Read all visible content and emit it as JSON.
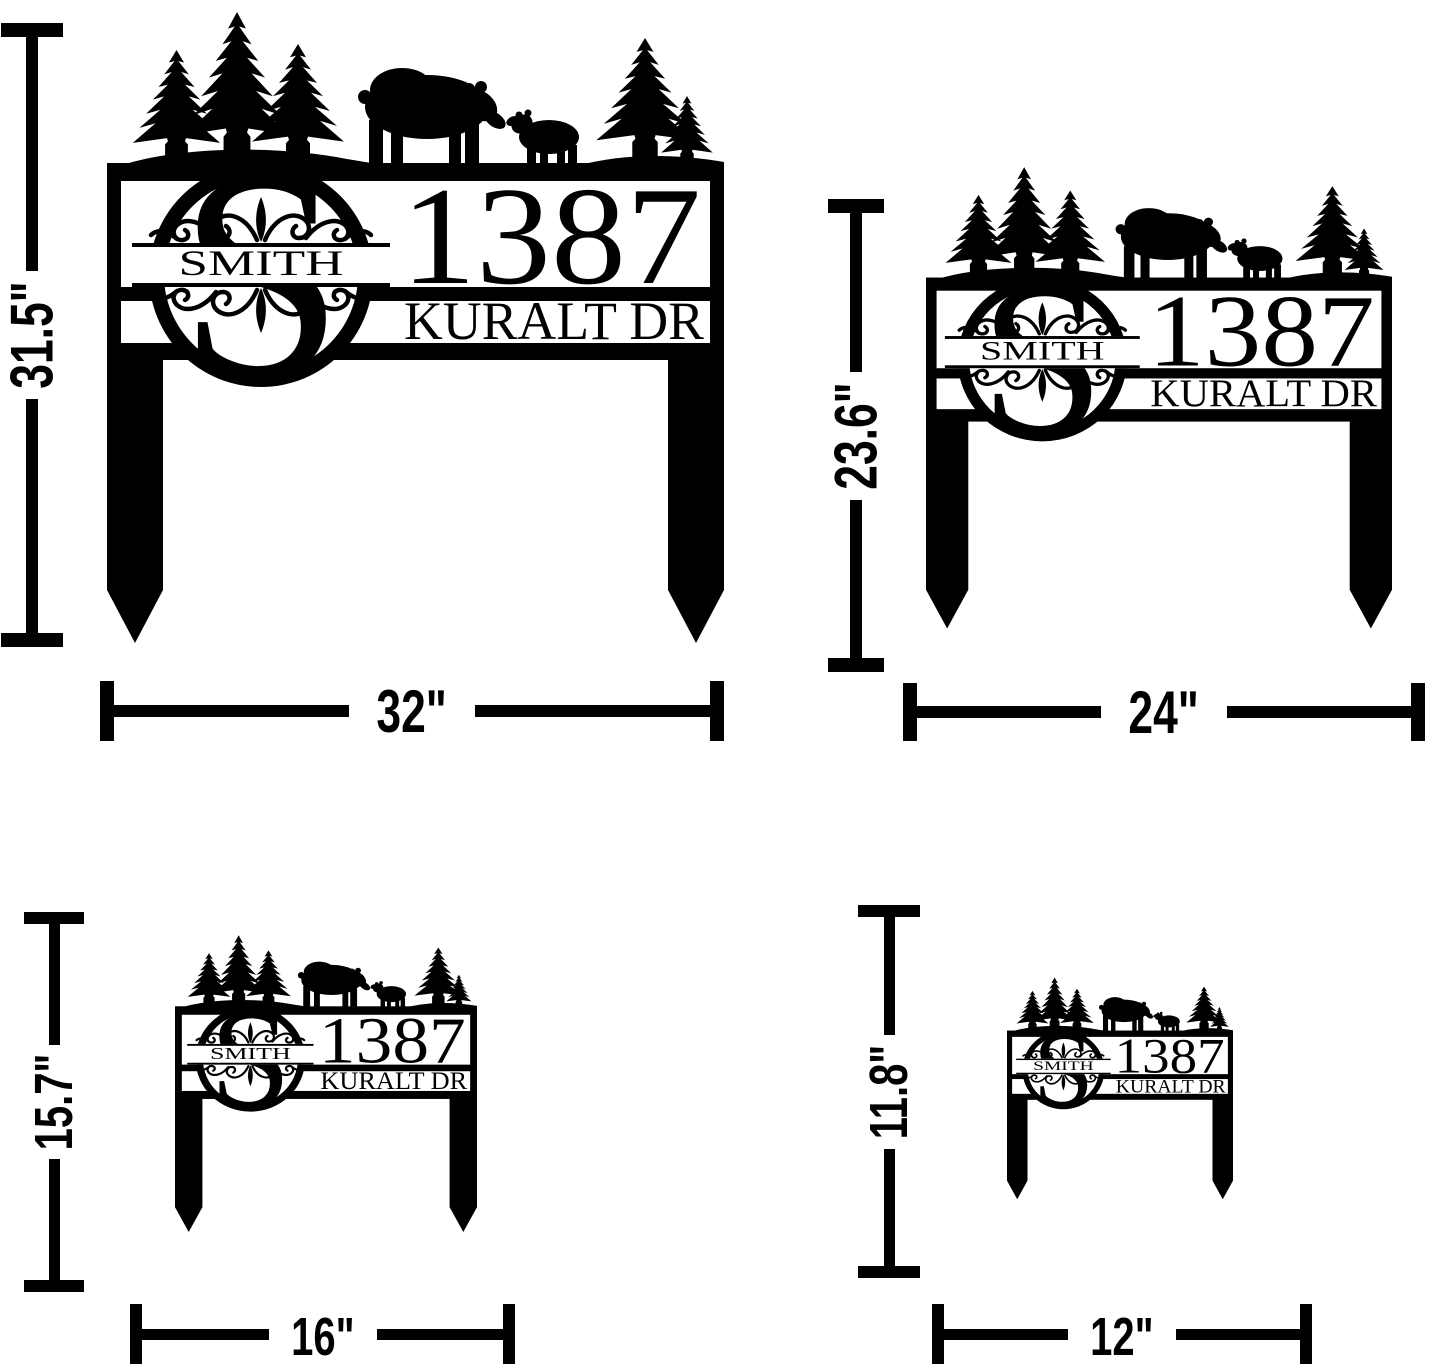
{
  "sign": {
    "monogram_letter": "S",
    "family_name": "SMITH",
    "address_number": "1387",
    "street_name": "KURALT DR"
  },
  "variants": [
    {
      "id": "large",
      "height_label": "31.5\"",
      "width_label": "32\""
    },
    {
      "id": "medium",
      "height_label": "23.6\"",
      "width_label": "24\""
    },
    {
      "id": "small",
      "height_label": "15.7\"",
      "width_label": "16\""
    },
    {
      "id": "xsmall",
      "height_label": "11.8\"",
      "width_label": "12\""
    }
  ],
  "colors": {
    "art": "#000000",
    "background": "#ffffff"
  }
}
